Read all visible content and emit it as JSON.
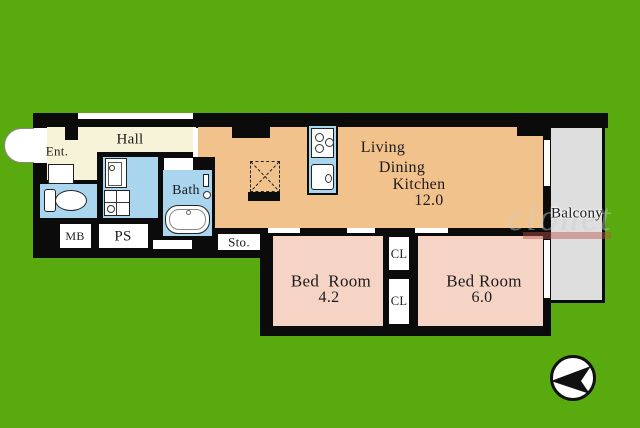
{
  "canvas": {
    "width": 640,
    "height": 428
  },
  "colors": {
    "background_green": "#58AA0E",
    "wall_black": "#0b0b0b",
    "hall_cream": "#F7F3D8",
    "water_blue": "#A9D6EE",
    "ldk_orange": "#F2C28C",
    "bedroom_pink": "#F6D4C5",
    "balcony_gray": "#DEDEDE"
  },
  "labels": {
    "ent": "Ent.",
    "hall": "Hall",
    "bath": "Bath",
    "mb": "MB",
    "ps": "PS",
    "sto": "Sto.",
    "ldk": {
      "l1": "Living",
      "l2": "Dining",
      "l3": "Kitchen",
      "area": "12.0"
    },
    "bedroom_small": {
      "name": "Bed  Room",
      "area": "4.2"
    },
    "bedroom_large": {
      "name": "Bed Room",
      "area": "6.0"
    },
    "closet_top": "CL",
    "closet_bottom": "CL",
    "balcony": "Balcony",
    "watermark": "clonet"
  },
  "icons": {
    "compass": "black-arrow-pointing-left-in-white-circle",
    "entrance_door": "white-door-swing-arc",
    "toilet": "tank-and-bowl",
    "vanity": "wash-basin-cabinet",
    "washer_pan": "square-with-cross",
    "bathtub": "rounded-tub",
    "stove": "three-burner-cooktop",
    "kitchen_sink": "sink-with-faucet",
    "refrigerator_space": "dashed-square-with-x"
  }
}
